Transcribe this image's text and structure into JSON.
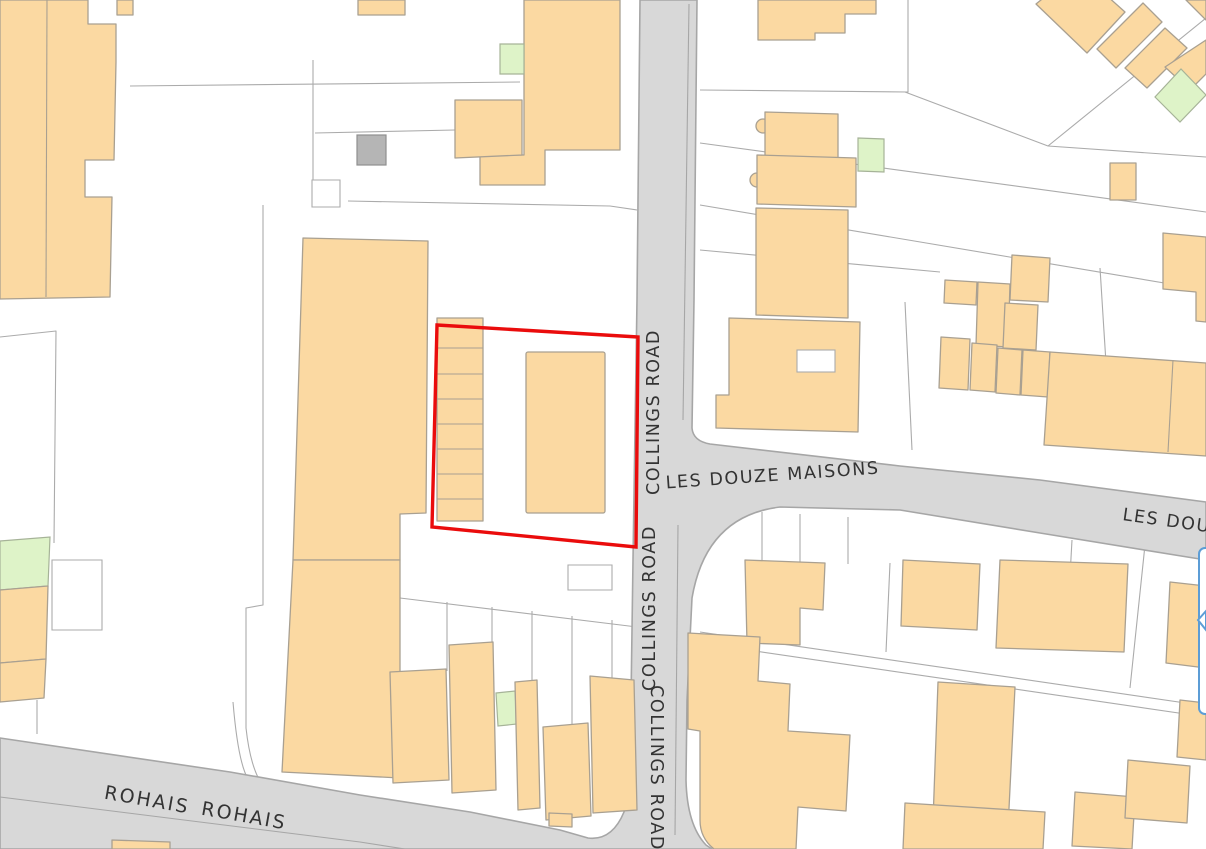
{
  "map": {
    "kind": "cadastral-street-map",
    "labels": {
      "collings_road": "COLLINGS ROAD",
      "les_douze_maisons": "LES DOUZE MAISONS",
      "rohais": "ROHAIS"
    },
    "site_boundary": {
      "shape": "red-outlined-quadrilateral",
      "contains": "garage strip block and central building"
    }
  },
  "colors": {
    "background": "#ffffff",
    "building_fill": "#fbd9a2",
    "building_stroke": "#a9a091",
    "green_fill": "#def3c8",
    "green_stroke": "#a6b398",
    "gray_building_fill": "#b5b5b5",
    "road_fill": "#d8d8d8",
    "road_casing": "#a6a6a6",
    "parcel_line": "#ababab",
    "label_color": "#333333",
    "site_boundary": "#ea0c0c",
    "popup_border": "#5c9dd6"
  }
}
